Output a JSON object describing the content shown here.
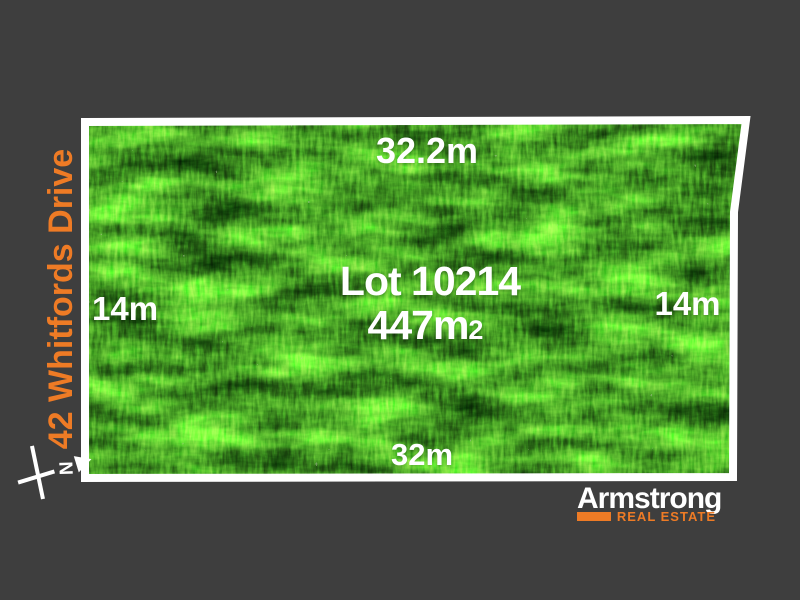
{
  "colors": {
    "background": "#3E3E3E",
    "accent_orange": "#EE7B25",
    "label_white": "#FFFFFF",
    "grass_green": "#4DA627",
    "border_white": "#FFFFFF"
  },
  "street": {
    "label": "42 Whitfords Drive"
  },
  "lot": {
    "title": "Lot 10214",
    "area": "447m",
    "area_exponent": "2",
    "dim_top": "32.2m",
    "dim_left": "14m",
    "dim_right": "14m",
    "dim_bottom": "32m"
  },
  "compass": {
    "letter": "N"
  },
  "logo": {
    "brand": "Armstrong",
    "tagline": "REAL ESTATE"
  }
}
